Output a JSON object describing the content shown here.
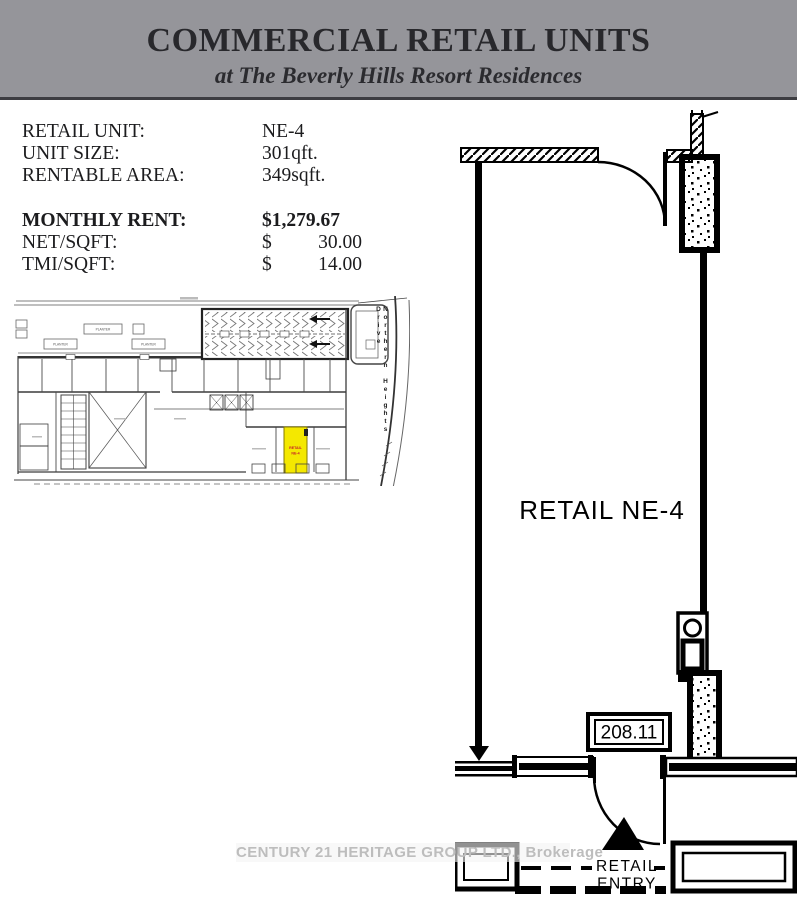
{
  "header": {
    "title": "COMMERCIAL RETAIL UNITS",
    "subtitle": "at The Beverly Hills Resort Residences"
  },
  "details": {
    "rows": [
      {
        "label": "RETAIL UNIT:",
        "value": "NE-4"
      },
      {
        "label": "UNIT SIZE:",
        "value": "301qft."
      },
      {
        "label": "RENTABLE AREA:",
        "value": "349sqft."
      }
    ],
    "rent": {
      "label": "MONTHLY RENT:",
      "value": "$1,279.67"
    },
    "net": {
      "label": "NET/SQFT:",
      "currency": "$",
      "amount": "30.00"
    },
    "tmi": {
      "label": "TMI/SQFT:",
      "currency": "$",
      "amount": "14.00"
    }
  },
  "site_plan": {
    "street": "Northern Heights Drive",
    "planter_a": "PLANTER",
    "planter_b": "PLANTER",
    "planter_c": "PLANTER",
    "unit": {
      "line1": "RETAIL",
      "line2": "NE-4"
    }
  },
  "floor_plan": {
    "unit_label": "RETAIL NE-4",
    "dimension": "208.11",
    "entry": {
      "line1": "RETAIL",
      "line2": "ENTRY"
    }
  },
  "watermark": {
    "text": "CENTURY 21 HERITAGE GROUP LTD., Brokerage"
  },
  "colors": {
    "header_bg": "#95959a",
    "highlight_yellow": "#f4e800",
    "unit_label_red": "#c42128"
  }
}
